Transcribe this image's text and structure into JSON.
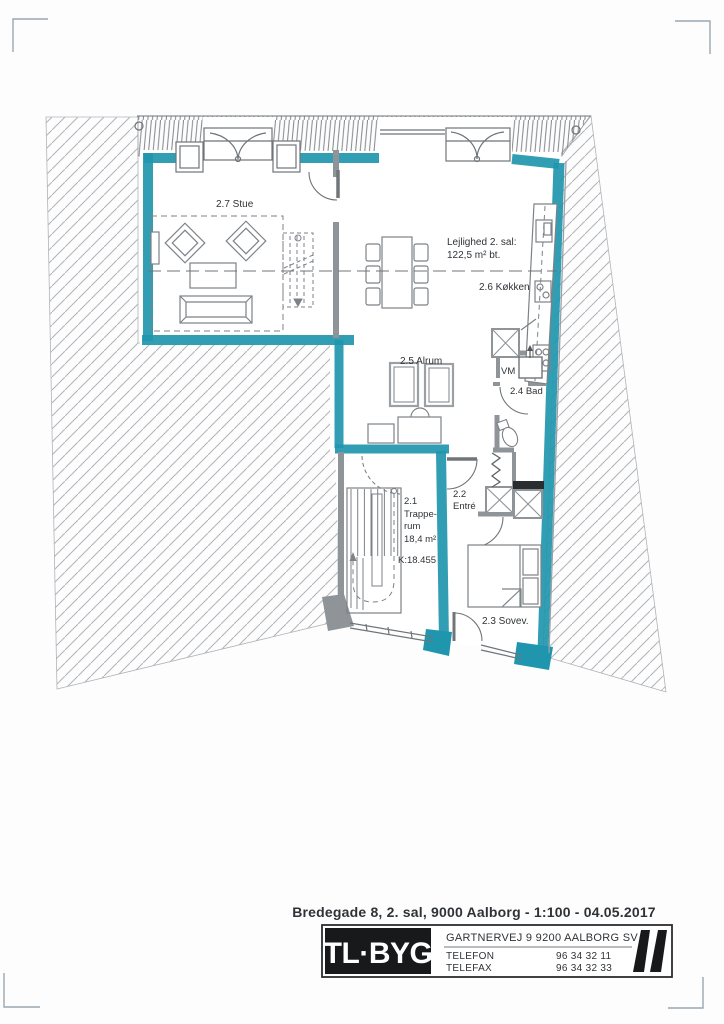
{
  "plan": {
    "labels": {
      "stue": "2.7 Stue",
      "apartment_line1": "Lejlighed 2. sal:",
      "apartment_line2": "122,5 m² bt.",
      "koekken": "2.6 Køkken",
      "alrum": "2.5 Alrum",
      "vm": "VM",
      "bad": "2.4 Bad",
      "entre_no": "2.2",
      "entre": "Entré",
      "trappe_no": "2.1",
      "trappe_l1": "Trappe-",
      "trappe_l2": "rum",
      "trappe_area": "18,4 m²",
      "kote": "K:18.455",
      "sovev": "2.3 Sovev."
    },
    "colors": {
      "highlight_teal": "#1f96ae",
      "wall_gray": "#8f9499",
      "hatch_gray": "#b0b4b8"
    }
  },
  "footer": {
    "title": "Bredegade 8, 2. sal, 9000 Aalborg - 1:100 - 04.05.2017",
    "company": "TL·BYG",
    "address": "GARTNERVEJ 9 9200 AALBORG SV",
    "telefon_label": "TELEFON",
    "telefon": "96 34 32 11",
    "telefax_label": "TELEFAX",
    "telefax": "96 34 32 33"
  }
}
